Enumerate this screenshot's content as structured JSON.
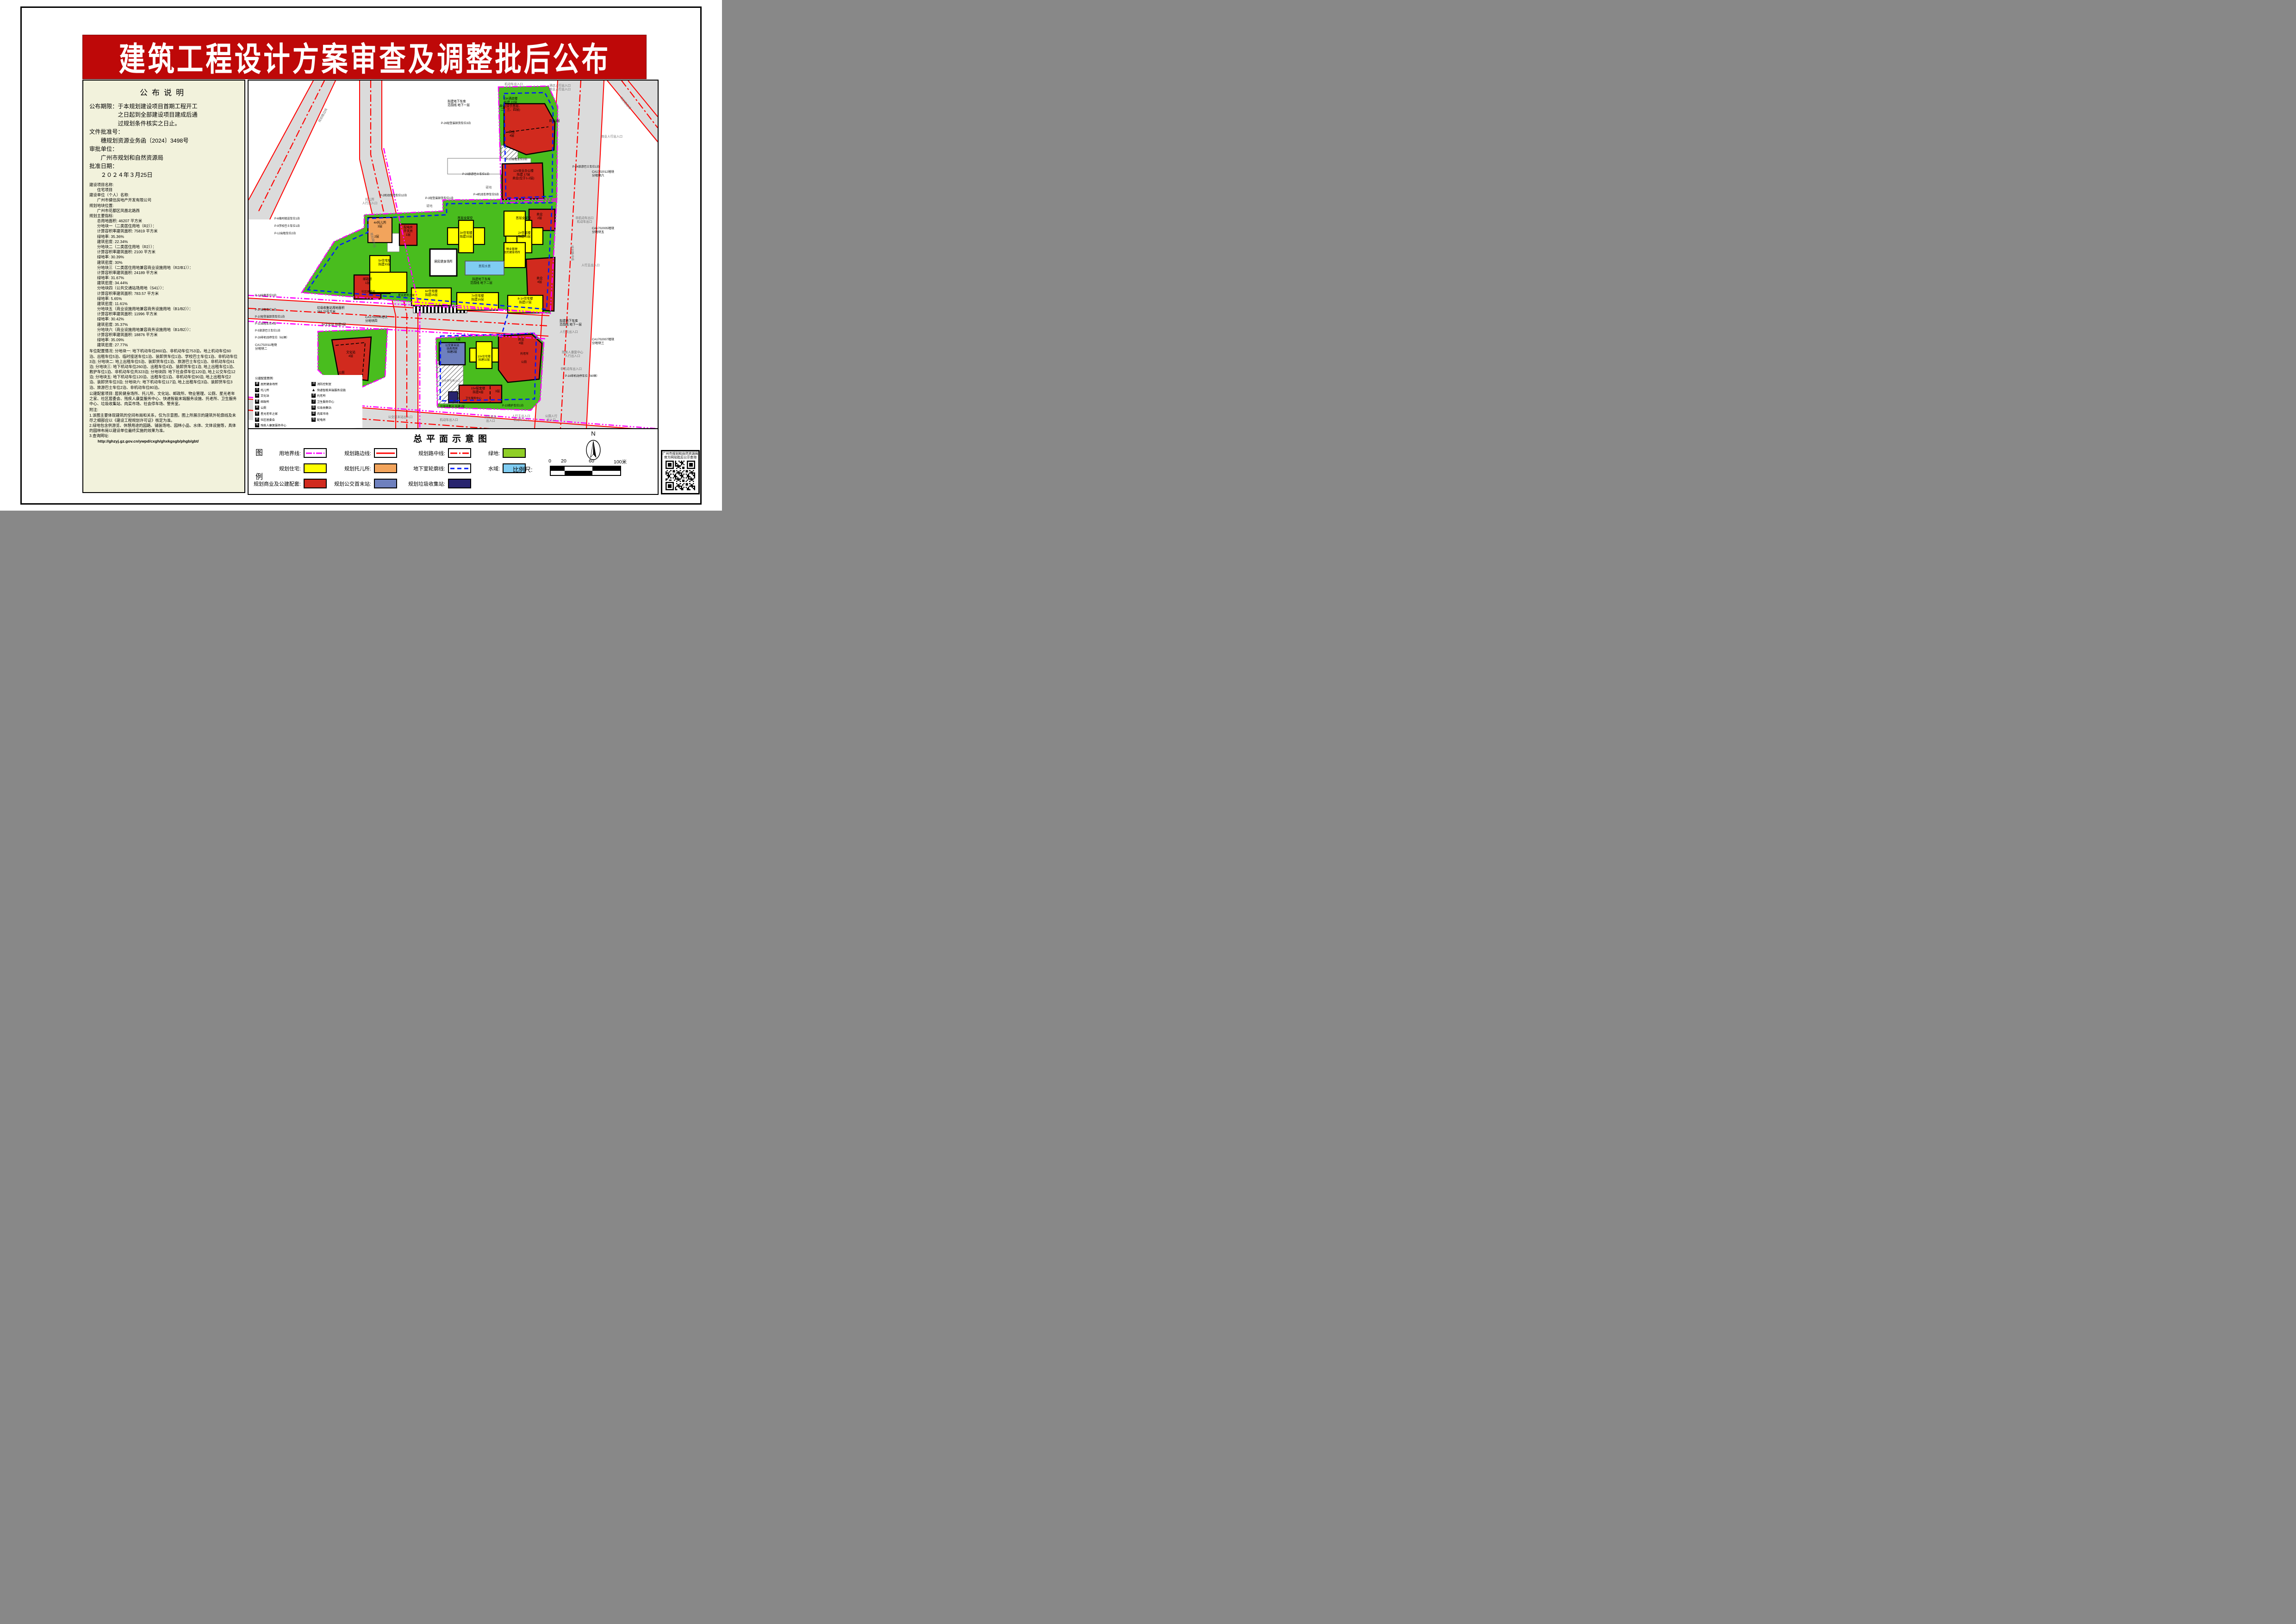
{
  "palette": {
    "banner_red": "#BE0808",
    "panel_bg": "#F2F2DC",
    "map_green": "#49BD1E",
    "legend_green": "#8FCE26",
    "residential_yellow": "#FFFF00",
    "commercial_red": "#D12A1E",
    "nursery_orange": "#F2A45C",
    "bus_blue": "#6E80BE",
    "waste_navy": "#28246E",
    "water_blue": "#7FCCF2",
    "boundary_magenta": "#FF00FF",
    "basement_blue": "#0018FF",
    "road_red": "#FF0000",
    "road_gray": "#DBDBDB"
  },
  "banner": {
    "title": "建筑工程设计方案审查及调整批后公布"
  },
  "announcement": {
    "title": "公布说明",
    "body": "公布期限：于本规划建设项目首期工程开工\n　　　　　之日起到全部建设项目建成后通\n　　　　　过规划条件核实之日止。\n文件批准号：\n　　穗规划资源业务函〔2024〕3498号\n审批单位：\n　　广州市规划和自然资源局\n批准日期：\n　　２０２４年３月25日",
    "indicators": "建设项目名称:\n　　住宅项目\n建设单位（个人）名称:\n　　广州市健信房地产开发有限公司\n规划地块位置:\n　　广州市花都区凤凰北路西\n规划主要指标:\n　　总用地面积: 46207 平方米\n　　分地块一（二类居住用地（R2））：\n　　计算容积率建筑面积: 75819 平方米\n　　绿地率: 35.36%\n　　建筑密度: 22.34%\n　　分地块二（二类居住用地（R2））：\n　　计算容积率建筑面积: 2100 平方米\n　　绿地率: 30.39%\n　　建筑密度: 30%\n　　分地块三（二类居住用地兼容商业设施用地（R2/B1））：\n　　计算容积率建筑面积: 24189 平方米\n　　绿地率: 31.67%\n　　建筑密度: 34.44%\n　　分地块四（公共交通站场用地（S41））：\n　　计算容积率建筑面积: 783.57 平方米\n　　绿地率: 5.65%\n　　建筑密度: 11.61%\n　　分地块五（商业设施用地兼容商务设施用地（B1/B2））：\n　　计算容积率建筑面积: 11996 平方米\n　　绿地率: 30.42%\n　　建筑密度: 35.37%\n　　分地块六（商业设施用地兼容商务设施用地（B1/B2））：\n　　计算容积率建筑面积: 18876 平方米\n　　绿地率: 35.09%\n　　建筑密度: 27.77%",
    "parking": "车位配置情况: 分地块一: 地下机动车位860泊、非机动车位753泊，地上机动车位60泊、出租车位5泊、临时接送车位1泊、装卸货车位1泊、学校巴士车位1泊、非机动车位3泊; 分地块二: 地上出租车位5泊、装卸货车位1泊、旅游巴士车位1泊、非机动车位61泊; 分地块三: 地下机动车位260泊、出租车位4泊、装卸货车位1泊, 地上出租车位1泊、救护车位1泊、非机动车位共323泊; 分地块四: 地下社会停车位120泊, 地上公交车位12泊; 分地块五: 地下机动车位120泊、出租车位1泊、非机动车位90泊, 地上出租车位2泊、装卸货车位3泊; 分地块六: 地下机动车位117泊, 地上出租车位3泊、装卸货车位3泊、旅游巴士车位2泊、非机动车位80泊。",
    "facilities": "公建配套项目: 居民健身场所、托儿所、文化站、邮政所、物业管理、公厕、星光老年之家、社区居委会、残疾人康复服务中心、快递智能末端服务设施、托老所、卫生服务中心、垃圾收集站、肉菜市场、社会停车场、警务室。",
    "notes": "附注:\n1.该图主要体现建筑的空间布局和关系，仅为示意图，图上所展示的建筑外轮廓线及未尽之细部应以《建设工程规划许可证》核定为准。\n2.绿地包含供游览、休憩用途的园路、铺装场地、园林小品、水体、文体设施等，具体的园林布局以建设单位最终实施的效果为准。\n3.查询网址:",
    "url": "http://ghzyj.gz.gov.cn/ywpd/cxgh/ghxkgsgb/phgb/gbt/"
  },
  "map": {
    "labels": {
      "hotel13": "13#酒店楼\n拟建 22层\n商业(设于首层、\n二、三、四层)",
      "office12": "12#商业办公楼\n拟建 17层\n商业(位于1-2层)",
      "biz3f": "商业3层",
      "biz4f": "商业\n4层",
      "biz2f": "商业\n2层",
      "res3": "3#住宅楼\n拟建33层",
      "res2": "2#住宅楼\n拟建33层",
      "stilt": "首层全架空",
      "nursery": "4#托儿所\n3层",
      "nursery2f": "2层",
      "power": "配电房\n开关房\n1层",
      "fitness": "居民健身场所",
      "pool": "景观水景",
      "garage_b2": "拟建地下车库\n范围线 地下二层",
      "garage_b1": "拟建地下车库\n范围线 地下一层",
      "res5": "5#住宅楼\n拟建33层",
      "post": "邮政所\n1层",
      "committee": "社区居委会",
      "elder_home": "星光老年之家",
      "res6": "6#住宅楼\n拟建16层",
      "res7": "7#住宅楼\n拟建16层",
      "res81": "8-1#住宅楼\n拟建17层",
      "pm": "物业管理\n居民健身场所",
      "culture9": "9#文化站 拟建5层",
      "culture4f": "文化站\n4层",
      "wc": "公厕",
      "bus": "公交首末站\n站务用房\n拟建2层",
      "bus1f": "1层",
      "res10": "10#住宅楼\n拟建32层",
      "elder_care": "托老所",
      "b15": "15#配套楼\n拟建4层",
      "health": "卫生服务中心",
      "f3": "3层",
      "waste": "垃圾收集站 拟建1层",
      "waste_area": "垃圾收集站用地面积\n268.70平方米",
      "ca11": "CA1702011地块\n分地块二",
      "ca12": "CA1702012地块\n分地块六",
      "ca05": "CA1702005地块\n分地块五",
      "ca06": "CA1702006地块\n分地块四",
      "ca07": "CA1702007地块\n分地块三",
      "p2": "P-2机动车停车位12泊",
      "p3": "P-3轻型装卸货车位1泊",
      "p4": "P-4机动车停车位5泊",
      "p5": "P-5旅游巴士车位1泊",
      "p6": "P-6临时接送车位1泊",
      "p9": "P-9学校巴士车位1泊",
      "p10": "P-10轻型装卸货车位1泊",
      "p11": "P-11出租车位4泊",
      "p12": "P-12出租车位2泊",
      "p13": "P-13出租车位3泊",
      "p15": "P-15救护车位1泊",
      "p16": "P-16非机动停车位（60辆）",
      "p22": "P-22出租车位3泊",
      "p23": "P-23旅游巴士车位1泊",
      "p24": "P-24旅游巴士车位1泊",
      "p26": "P-26轻型装卸货车位3泊",
      "p27": "P-27出租车位1泊",
      "p28": "P-28非机动停车位（61辆）",
      "ent_motor": "机动车出入口",
      "ent_hotel_ped": "酒店人行出入口\n商业人行出入口",
      "ent_biz_ped": "商业人行出入口",
      "ent_nonmotor_out": "非机动车出口\n机动车出口",
      "ent_ped_main": "人行主出入口",
      "ent_ped_sec": "人行次出入口",
      "ent_nonmotor": "非机动车出入口",
      "ent_rehab": "残疾人康复中心\n人行出入口",
      "ent_nursery": "托儿所\n人行出入口",
      "ent_bus_term": "公交首末站出入口",
      "ent_fire": "消防紧急\n出入口",
      "ent_main_motor": "人行主出入口\n机动车入口",
      "ent_wc": "公厕人行\n出入口",
      "ent_parking": "社会停车场入口",
      "rd_edge": "规划路边线",
      "rd_center": "规划路中线",
      "hard": "硬地"
    },
    "minilegend": {
      "title": "公建配套图例:",
      "items": [
        {
          "g": "健",
          "s": "sq",
          "label": "居民健身场所"
        },
        {
          "g": "托",
          "s": "sq",
          "label": "托儿所"
        },
        {
          "g": "文",
          "s": "sq",
          "label": "文化站"
        },
        {
          "g": "邮",
          "s": "sq",
          "label": "邮政所"
        },
        {
          "g": "厕",
          "s": "sq",
          "label": "公厕"
        },
        {
          "g": "星",
          "s": "sq",
          "label": "星光老年之家"
        },
        {
          "g": "居",
          "s": "sq",
          "label": "社区居委会"
        },
        {
          "g": "残",
          "s": "sq",
          "label": "残疾人康复服务中心"
        },
        {
          "g": "消",
          "s": "sq",
          "label": "消防控制室"
        },
        {
          "g": "▲",
          "s": "tri",
          "label": "快递智能末端服务设施"
        },
        {
          "g": "老",
          "s": "sq",
          "label": "托老所"
        },
        {
          "g": "卫",
          "s": "sq",
          "label": "卫生服务中心"
        },
        {
          "g": "圾",
          "s": "sq",
          "label": "垃圾收集站"
        },
        {
          "g": "菜",
          "s": "sq",
          "label": "肉菜市场"
        },
        {
          "g": "电",
          "s": "sq",
          "label": "配电房"
        }
      ]
    }
  },
  "legend": {
    "title": "总平面示意图",
    "box_top": "图",
    "box_bottom": "例",
    "items": [
      {
        "label": "用地界线:",
        "swatch": "boundary"
      },
      {
        "label": "规划路边线:",
        "swatch": "roadedge"
      },
      {
        "label": "规划路中线:",
        "swatch": "roadcenter"
      },
      {
        "label": "绿地:",
        "swatch": "green"
      },
      {
        "label": "规划住宅:",
        "swatch": "residential"
      },
      {
        "label": "规划托儿所:",
        "swatch": "nursery"
      },
      {
        "label": "地下室轮廓线:",
        "swatch": "basement"
      },
      {
        "label": "水域:",
        "swatch": "water"
      },
      {
        "label": "规划商业及公建配套:",
        "swatch": "commercial"
      },
      {
        "label": "规划公交首末站:",
        "swatch": "bus"
      },
      {
        "label": "规划垃圾收集站:",
        "swatch": "waste"
      }
    ],
    "scale": {
      "label": "比例尺:",
      "ticks": [
        "0",
        "20",
        "60",
        "100米"
      ]
    },
    "compass": "N"
  },
  "qr": {
    "caption": "广州市规划和自然资源局\n官方网站批后公示查询"
  }
}
